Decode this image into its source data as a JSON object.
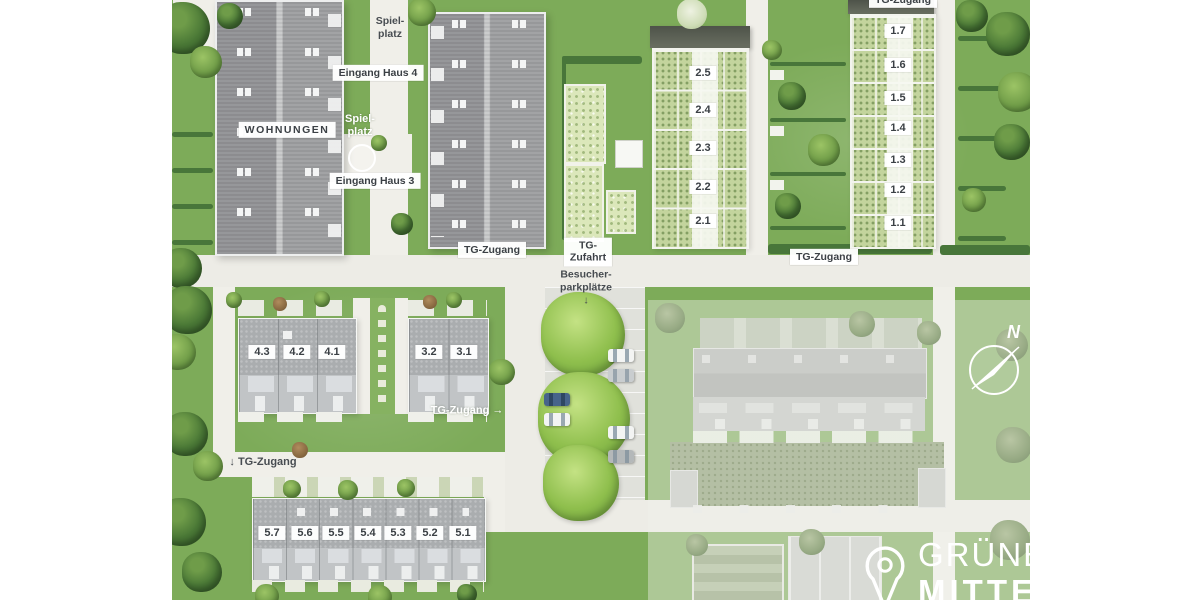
{
  "colors": {
    "lawn": "#7dab59",
    "path": "#f0efe9",
    "apartment_roof": "#9b9c9e",
    "rowhouse_roof": "#aaadaf",
    "green_roof": "#c3d49d",
    "bright_tree": "#8fbf4d",
    "label_text": "#3b4045",
    "muted_building": "#c9cbc7",
    "logo_white": "#ffffff"
  },
  "labels": {
    "spielplatz_top": "Spiel-\nplatz",
    "eingang_haus_4": "Eingang Haus 4",
    "wohnungen": "WOHNUNGEN",
    "spielplatz_mid": "Spiel-\nplatz",
    "eingang_haus_3": "Eingang Haus 3",
    "tg_zugang_haus3": "TG-Zugang",
    "tg_zufahrt": "TG-\nZufahrt",
    "besucher_parkplaetze": "Besucher-\nparkplätze\n↓",
    "tg_zugang_right": "TG-Zugang",
    "tg_zugang_top": "TG-Zugang",
    "tg_zugang_mid_arrow": "TG-Zugang →",
    "tg_zugang_bottom": "↓ TG-Zugang"
  },
  "unit_rows": {
    "row1": {
      "name": "haus-1",
      "units": [
        "1.7",
        "1.6",
        "1.5",
        "1.4",
        "1.3",
        "1.2",
        "1.1"
      ]
    },
    "row2": {
      "name": "haus-2",
      "units": [
        "2.5",
        "2.4",
        "2.3",
        "2.2",
        "2.1"
      ]
    },
    "row3": {
      "name": "haus-3",
      "units": [
        "3.2",
        "3.1"
      ]
    },
    "row4": {
      "name": "haus-4",
      "units": [
        "4.3",
        "4.2",
        "4.1"
      ]
    },
    "row5": {
      "name": "haus-5",
      "units": [
        "5.7",
        "5.6",
        "5.5",
        "5.4",
        "5.3",
        "5.2",
        "5.1"
      ]
    }
  },
  "compass": {
    "north": "N"
  },
  "logo": {
    "line1": "GRÜNE",
    "line2": "MITTE"
  }
}
